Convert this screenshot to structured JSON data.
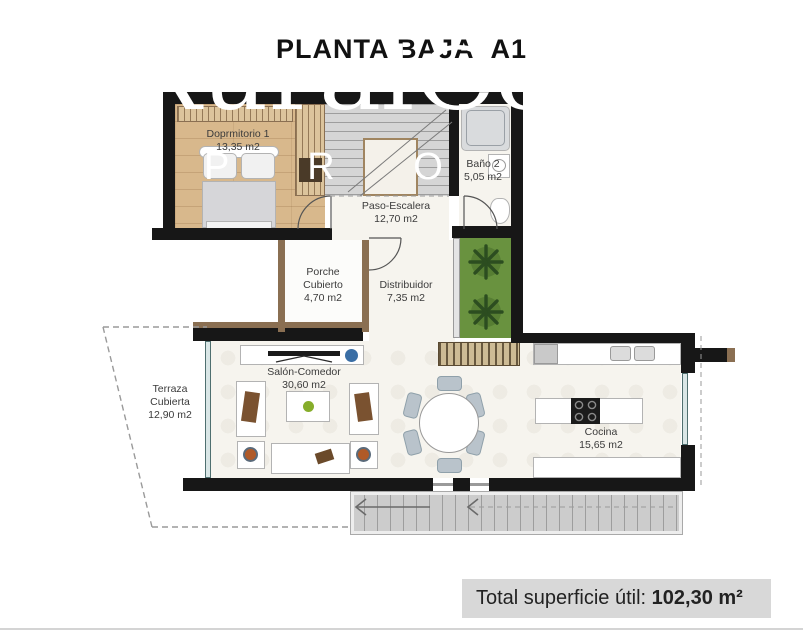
{
  "title": {
    "main": "PLANTA BAJA",
    "variant": "A1"
  },
  "watermark": {
    "brand": "RuralCoast",
    "tagline": "P R O P E R T I E S"
  },
  "rooms": {
    "dormitorio": {
      "lines": [
        "Doprmitorio 1",
        "13,35 m2"
      ]
    },
    "bano": {
      "lines": [
        "Baño 2",
        "5,05 m2"
      ]
    },
    "paso": {
      "lines": [
        "Paso-Escalera",
        "12,70 m2"
      ]
    },
    "porche": {
      "lines": [
        "Porche",
        "Cubierto",
        "4,70 m2"
      ]
    },
    "distribuidor": {
      "lines": [
        "Distribuidor",
        "7,35 m2"
      ]
    },
    "terraza": {
      "lines": [
        "Terraza",
        "Cubierta",
        "12,90 m2"
      ]
    },
    "salon": {
      "lines": [
        "Salón-Comedor",
        "30,60 m2"
      ]
    },
    "cocina": {
      "lines": [
        "Cocina",
        "15,65 m2"
      ]
    }
  },
  "footer": {
    "label": "Total superficie útil:",
    "value": "102,30 m²"
  },
  "colors": {
    "wall": "#171717",
    "wood_floor": "#d8b88c",
    "garden_green": "#69923f",
    "stairs_gray": "#d5d5d5",
    "footer_bg": "#d8d8d8",
    "tv_speaker_blue": "#3a6ea5",
    "cushion_brown": "#7a5230",
    "apple_green": "#86ad2a",
    "plate_orange": "#b05a28"
  }
}
